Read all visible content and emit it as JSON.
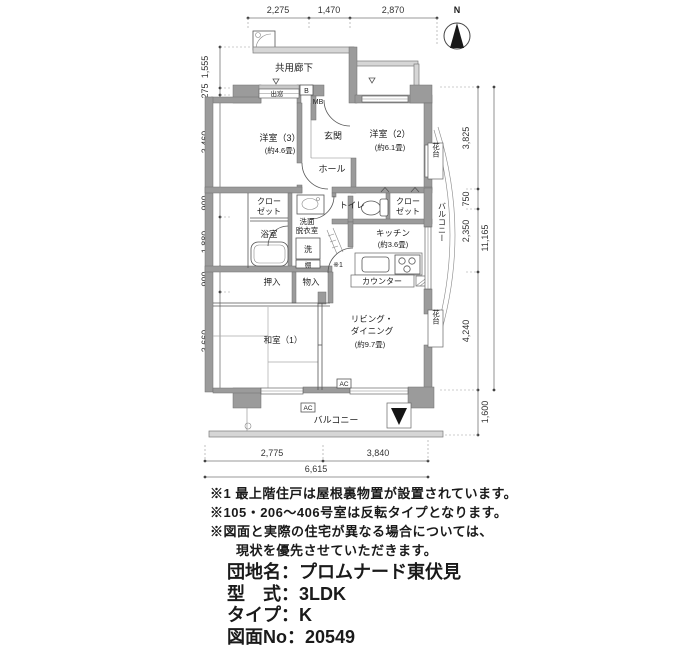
{
  "compass": {
    "label": "N"
  },
  "dims": {
    "top": [
      "2,275",
      "1,470",
      "2,870"
    ],
    "left": [
      "1,555",
      "275",
      "3,460",
      "900",
      "1,880",
      "900",
      "3,660"
    ],
    "right": [
      "3,825",
      "750",
      "2,350",
      "4,240"
    ],
    "right_balcony": "1,600",
    "right_total": "11,165",
    "bottom": [
      "2,775",
      "3,840"
    ],
    "bottom_total": "6,615"
  },
  "rooms": {
    "corridor": "共用廊下",
    "bay_window": "出窓",
    "b": "B",
    "mb": "MB",
    "western3": "洋室（3）",
    "western3_size": "(約4.6畳)",
    "western2": "洋室（2）",
    "western2_size": "(約6.1畳)",
    "entrance": "玄関",
    "hall": "ホール",
    "closet_line1": "クロー",
    "closet_line2": "ゼット",
    "washroom_line1": "洗面",
    "washroom_line2": "脱衣室",
    "bathroom": "浴室",
    "washer": "洗",
    "shelf": "棚",
    "toilet": "トイレ",
    "kitchen": "キッチン",
    "kitchen_size": "(約3.6畳)",
    "counter": "カウンター",
    "oshiire": "押入",
    "storage": "物入",
    "japanese1": "和室（1）",
    "living_line1": "リビング・",
    "living_line2": "ダイニング",
    "living_size": "(約9.7畳)",
    "flower_stand": "花台",
    "balcony": "バルコニー",
    "ac": "AC",
    "note_mark": "※1"
  },
  "notes": [
    "※1 最上階住戸は屋根裏物置が設置されています。",
    "※105・206〜406号室は反転タイプとなります。",
    "※図面と実際の住宅が異なる場合については、",
    "現状を優先させていただきます。"
  ],
  "info": [
    {
      "label": "団地名：",
      "value": "プロムナード東伏見"
    },
    {
      "label": "型　式：",
      "value": "3LDK"
    },
    {
      "label": "タイプ：",
      "value": "K"
    },
    {
      "label": "図面No：",
      "value": "20549"
    }
  ]
}
